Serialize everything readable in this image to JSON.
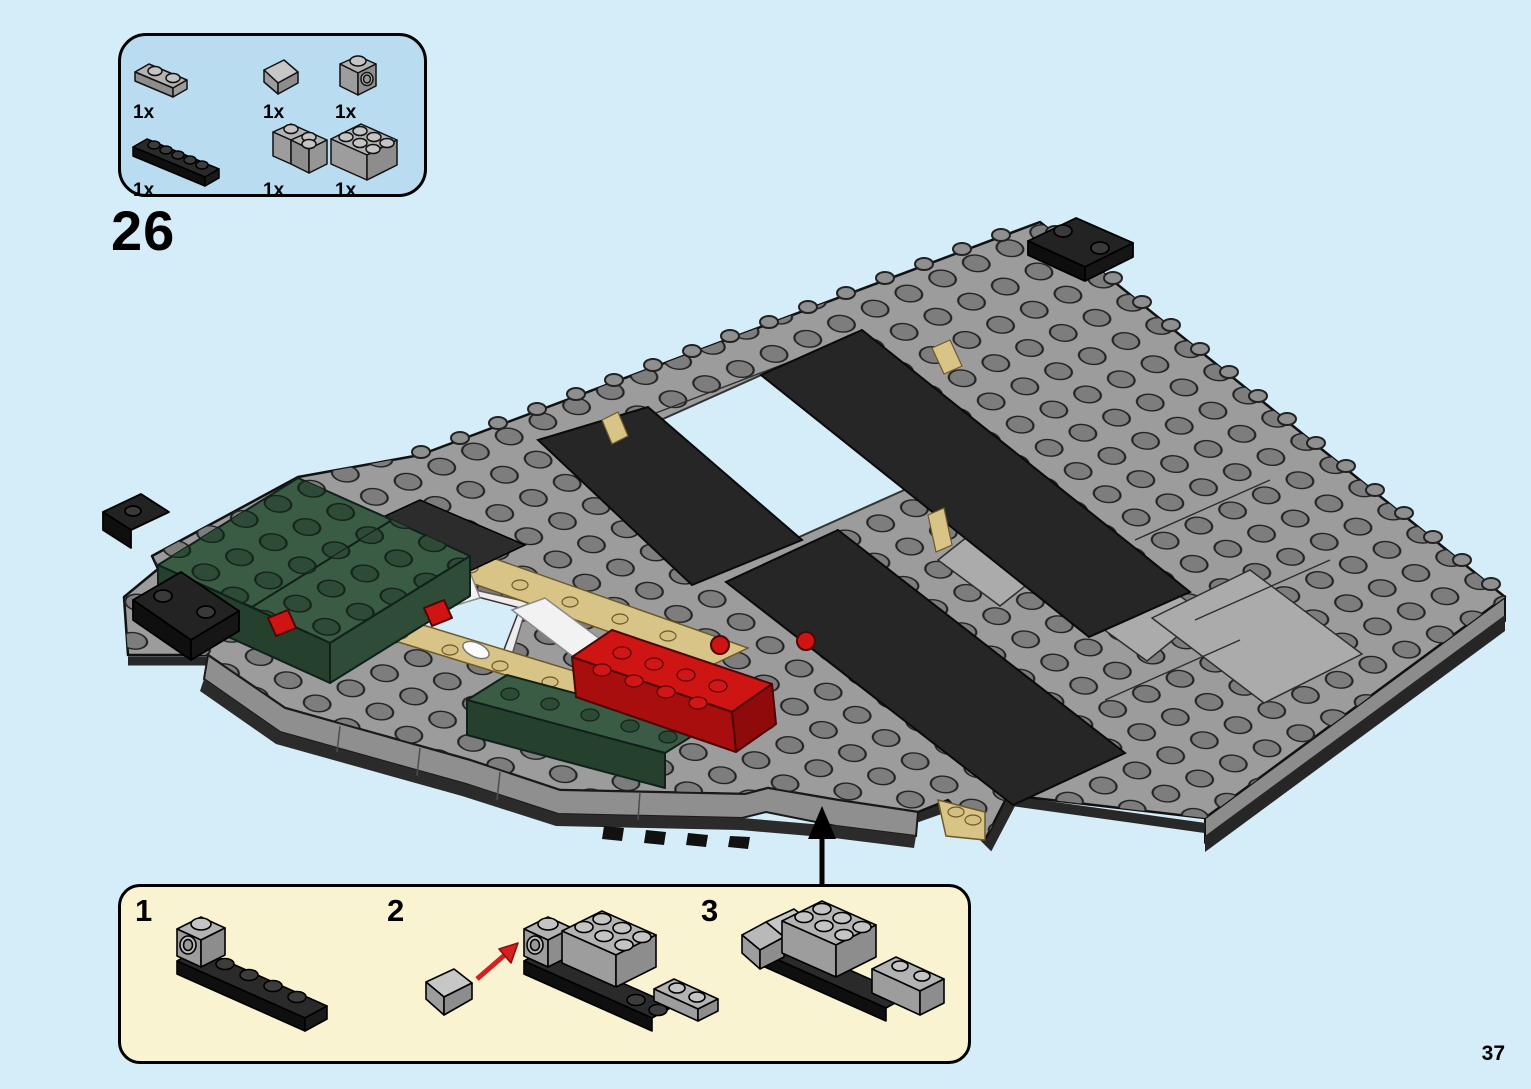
{
  "page": {
    "background_color": "#d5ecf9",
    "step_number": "26",
    "page_number": "37"
  },
  "parts_box": {
    "items": [
      {
        "qty": "1x",
        "part": "light-gray-1x2-plate"
      },
      {
        "qty": "1x",
        "part": "light-gray-slope-brick"
      },
      {
        "qty": "1x",
        "part": "light-gray-1x1-brick-with-side-stud"
      },
      {
        "qty": "1x",
        "part": "black-1x6-plate"
      },
      {
        "qty": "1x",
        "part": "light-gray-2x2-corner-brick"
      },
      {
        "qty": "1x",
        "part": "light-gray-2x3-brick"
      }
    ]
  },
  "callout_box": {
    "steps": [
      {
        "number": "1"
      },
      {
        "number": "2"
      },
      {
        "number": "3"
      }
    ]
  },
  "colors": {
    "background_blue": "#d5ecf9",
    "parts_box_blue": "#b9dcf0",
    "callout_cream": "#faf3d2",
    "plate_gray": "#9c9c9c",
    "stud_gray": "#7d7d7d",
    "smooth_gray": "#ababab",
    "panel_black": "#262626",
    "brick_black": "#232323",
    "dark_green": "#3a5c44",
    "red": "#cf1414",
    "tan": "#d9c488",
    "white": "#f2f2f2",
    "outline": "#111111",
    "arrow_black": "#000000",
    "arrow_red": "#d42020"
  }
}
